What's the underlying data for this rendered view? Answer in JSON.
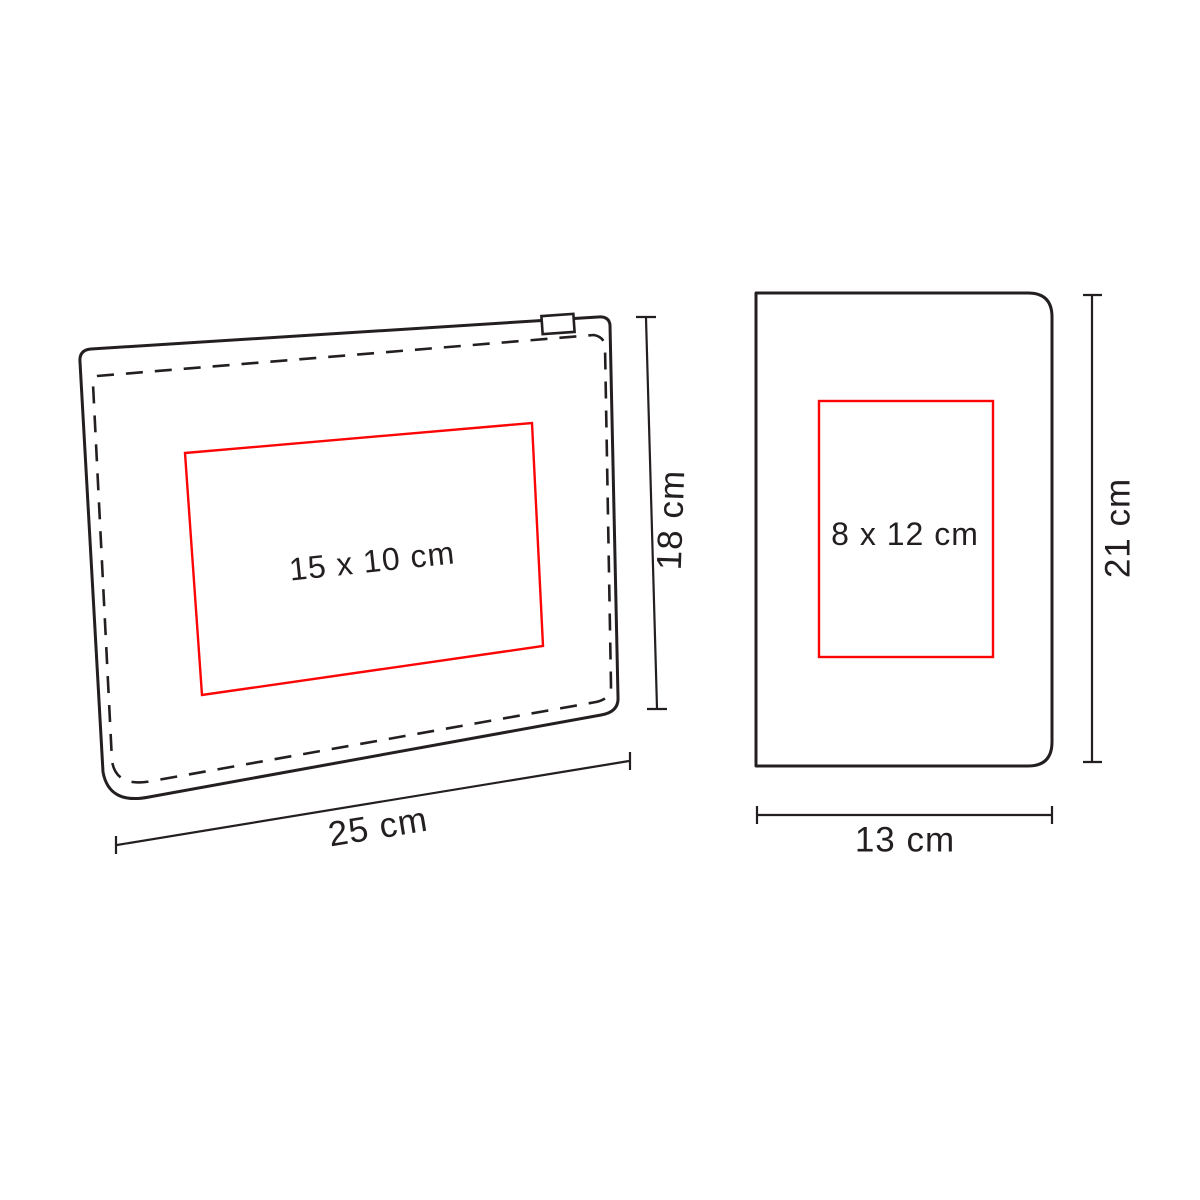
{
  "colors": {
    "line": "#231f20",
    "print_area": "#fb0505",
    "background": "#ffffff"
  },
  "pouch": {
    "print_area_label": "15 x 10 cm",
    "height_label": "18 cm",
    "width_label": "25 cm"
  },
  "notebook": {
    "print_area_label": "8 x 12 cm",
    "height_label": "21 cm",
    "width_label": "13 cm"
  }
}
